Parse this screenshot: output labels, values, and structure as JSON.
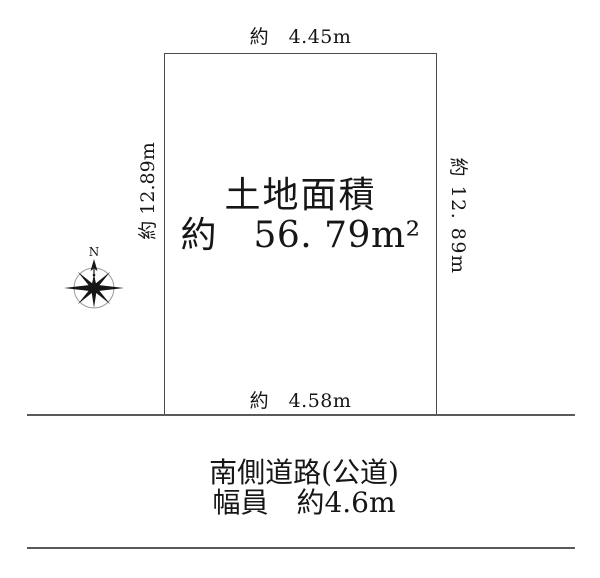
{
  "diagram": {
    "type": "land-plot-site-plan",
    "background_color": "#ffffff",
    "line_color": "#4a4a4a",
    "text_color": "#161616",
    "compass_circle_color": "#9a9a9a"
  },
  "plot": {
    "area_title": "土地面積",
    "area_value": "約　56. 79m²"
  },
  "dimensions": {
    "top": "約　4.45m",
    "bottom": "約　4.58m",
    "left": "約 12.89m",
    "right": "約 12. 89m"
  },
  "road": {
    "line1": "南側道路(公道)",
    "line2": "幅員　約4.6m"
  },
  "compass": {
    "north_label": "N"
  }
}
